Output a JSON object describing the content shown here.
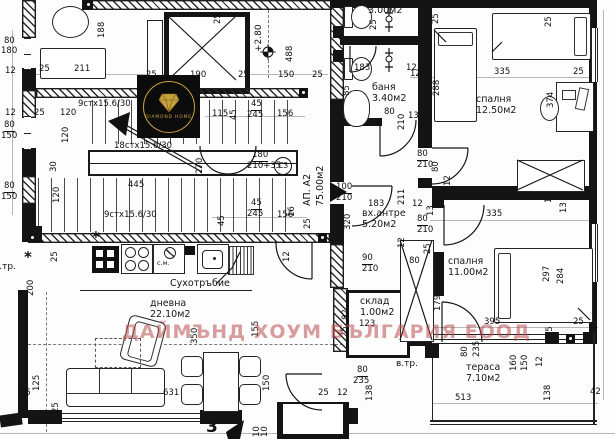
{
  "watermark": {
    "text": "ДАЙМЪНД ХОУМ БЪЛГАРИЯ ЕООД"
  },
  "logo": {
    "brand": "DIAMOND HOME",
    "accent": "#c8a23c",
    "bg": "#0c0c0c"
  },
  "apartment": {
    "label": "АП. А2",
    "area": "75.00м2"
  },
  "rooms": [
    {
      "id": "bath-upper",
      "name": "баня",
      "area": "3.00м2",
      "x": 368,
      "y": -6
    },
    {
      "id": "bath-lower",
      "name": "баня",
      "area": "3.40м2",
      "x": 372,
      "y": 82
    },
    {
      "id": "bedroom-right",
      "name": "спалня",
      "area": "12.50м2",
      "x": 476,
      "y": 94
    },
    {
      "id": "entry-hall",
      "name": "вх.антре",
      "area": "5.20м2",
      "x": 362,
      "y": 208
    },
    {
      "id": "bedroom-lower",
      "name": "спалня",
      "area": "11.00м2",
      "x": 448,
      "y": 256
    },
    {
      "id": "storage",
      "name": "склад",
      "area": "1.00м2",
      "x": 360,
      "y": 296
    },
    {
      "id": "living",
      "name": "дневна",
      "area": "22.10м2",
      "x": 150,
      "y": 298
    },
    {
      "id": "terrace",
      "name": "тераса",
      "area": "7.10м2",
      "x": 466,
      "y": 362
    }
  ],
  "stair_labels": [
    {
      "text": "9стх15.6/30",
      "x": 78,
      "y": 100
    },
    {
      "text": "18стх15.6/30",
      "x": 114,
      "y": 142
    },
    {
      "text": "9стх15.6/30",
      "x": 104,
      "y": 211
    }
  ],
  "annotations": [
    {
      "id": "dry-riser-label",
      "text": "Сухотръбие",
      "x": 170,
      "y": 279,
      "fs": 9.5
    },
    {
      "id": "washing-machine-label",
      "text": "с.м.",
      "x": 157,
      "y": 260,
      "fs": 6.5
    },
    {
      "id": "vent-pipe-label-right",
      "text": "в.тр.",
      "x": 396,
      "y": 360,
      "fs": 9
    },
    {
      "id": "vent-pipe-label-left",
      "text": "в.тр.",
      "x": -6,
      "y": 263,
      "fs": 9
    },
    {
      "id": "level-mark",
      "text": "+2.80",
      "x": 255,
      "y": 52,
      "fs": 9,
      "rot": 1
    },
    {
      "id": "door-code",
      "text": "СЗ",
      "x": 274,
      "y": 157,
      "fs": 7.5,
      "circle": 1
    },
    {
      "id": "axis-number",
      "text": "3",
      "x": 206,
      "y": 419,
      "fs": 17,
      "bold": 1
    }
  ],
  "dimensions": [
    {
      "t": "80",
      "x": 4,
      "y": 37
    },
    {
      "t": "180",
      "x": 1,
      "y": 47
    },
    {
      "t": "12",
      "x": 5,
      "y": 67
    },
    {
      "t": "25",
      "x": 39,
      "y": 65
    },
    {
      "t": "211",
      "x": 74,
      "y": 65
    },
    {
      "t": "188",
      "x": 98,
      "y": 38,
      "r": 1
    },
    {
      "t": "12",
      "x": 5,
      "y": 109
    },
    {
      "t": "25",
      "x": 34,
      "y": 109
    },
    {
      "t": "120",
      "x": 60,
      "y": 109
    },
    {
      "t": "80",
      "x": 4,
      "y": 121,
      "u": 1
    },
    {
      "t": "150",
      "x": 1,
      "y": 132
    },
    {
      "t": "80",
      "x": 4,
      "y": 182,
      "u": 1
    },
    {
      "t": "150",
      "x": 1,
      "y": 193
    },
    {
      "t": "120",
      "x": 62,
      "y": 143,
      "r": 1
    },
    {
      "t": "30",
      "x": 50,
      "y": 172,
      "r": 1
    },
    {
      "t": "25",
      "x": 146,
      "y": 71
    },
    {
      "t": "190",
      "x": 190,
      "y": 71
    },
    {
      "t": "25",
      "x": 238,
      "y": 71
    },
    {
      "t": "150",
      "x": 278,
      "y": 71
    },
    {
      "t": "25",
      "x": 312,
      "y": 71
    },
    {
      "t": "25",
      "x": 214,
      "y": 24,
      "r": 1
    },
    {
      "t": "488",
      "x": 286,
      "y": 62,
      "r": 1
    },
    {
      "t": "445",
      "x": 128,
      "y": 181
    },
    {
      "t": "120",
      "x": 53,
      "y": 203,
      "r": 1
    },
    {
      "t": "270",
      "x": 196,
      "y": 174,
      "r": 1
    },
    {
      "t": "115",
      "x": 212,
      "y": 110
    },
    {
      "t": "45",
      "x": 230,
      "y": 120,
      "r": 1
    },
    {
      "t": "45",
      "x": 251,
      "y": 100,
      "u": 1
    },
    {
      "t": "245",
      "x": 247,
      "y": 111
    },
    {
      "t": "156",
      "x": 277,
      "y": 110
    },
    {
      "t": "45",
      "x": 218,
      "y": 226,
      "r": 1
    },
    {
      "t": "45",
      "x": 251,
      "y": 199,
      "u": 1
    },
    {
      "t": "245",
      "x": 247,
      "y": 210
    },
    {
      "t": "156",
      "x": 277,
      "y": 211
    },
    {
      "t": "16",
      "x": 288,
      "y": 217,
      "r": 1
    },
    {
      "t": "25",
      "x": 304,
      "y": 229,
      "r": 1
    },
    {
      "t": "12",
      "x": 283,
      "y": 262,
      "r": 1
    },
    {
      "t": "180",
      "x": 252,
      "y": 151,
      "u": 1
    },
    {
      "t": "210+35",
      "x": 247,
      "y": 162
    },
    {
      "t": "100",
      "x": 336,
      "y": 183,
      "u": 1
    },
    {
      "t": "210",
      "x": 336,
      "y": 194
    },
    {
      "t": "320",
      "x": 344,
      "y": 230,
      "r": 1
    },
    {
      "t": "211",
      "x": 398,
      "y": 205,
      "r": 1
    },
    {
      "t": "183",
      "x": 368,
      "y": 200
    },
    {
      "t": "90",
      "x": 362,
      "y": 254,
      "u": 1
    },
    {
      "t": "210",
      "x": 362,
      "y": 265
    },
    {
      "t": "25",
      "x": 370,
      "y": 30,
      "r": 1
    },
    {
      "t": "183",
      "x": 354,
      "y": 64
    },
    {
      "t": "12",
      "x": 406,
      "y": 64
    },
    {
      "t": "85",
      "x": 343,
      "y": 96,
      "r": 1
    },
    {
      "t": "80",
      "x": 384,
      "y": 108
    },
    {
      "t": "210",
      "x": 398,
      "y": 130,
      "r": 1
    },
    {
      "t": "12",
      "x": 410,
      "y": 70
    },
    {
      "t": "13",
      "x": 408,
      "y": 112
    },
    {
      "t": "25",
      "x": 432,
      "y": 24,
      "r": 1
    },
    {
      "t": "25",
      "x": 545,
      "y": 27,
      "r": 1
    },
    {
      "t": "335",
      "x": 494,
      "y": 68
    },
    {
      "t": "25",
      "x": 573,
      "y": 68
    },
    {
      "t": "288",
      "x": 433,
      "y": 96,
      "r": 1
    },
    {
      "t": "374",
      "x": 547,
      "y": 108,
      "r": 1
    },
    {
      "t": "80",
      "x": 417,
      "y": 150,
      "u": 1
    },
    {
      "t": "210",
      "x": 417,
      "y": 161
    },
    {
      "t": "80",
      "x": 432,
      "y": 172,
      "r": 1
    },
    {
      "t": "12",
      "x": 444,
      "y": 186,
      "r": 1
    },
    {
      "t": "12",
      "x": 545,
      "y": 203,
      "r": 1
    },
    {
      "t": "13",
      "x": 560,
      "y": 213,
      "r": 1
    },
    {
      "t": "12",
      "x": 412,
      "y": 200
    },
    {
      "t": "13",
      "x": 427,
      "y": 216,
      "r": 1
    },
    {
      "t": "335",
      "x": 486,
      "y": 210
    },
    {
      "t": "80",
      "x": 417,
      "y": 215,
      "u": 1
    },
    {
      "t": "210",
      "x": 417,
      "y": 226
    },
    {
      "t": "25",
      "x": 424,
      "y": 254,
      "r": 1
    },
    {
      "t": "80",
      "x": 409,
      "y": 257
    },
    {
      "t": "179",
      "x": 434,
      "y": 311,
      "r": 1
    },
    {
      "t": "297",
      "x": 543,
      "y": 282,
      "r": 1
    },
    {
      "t": "284",
      "x": 557,
      "y": 284,
      "r": 1
    },
    {
      "t": "82",
      "x": 342,
      "y": 320,
      "r": 1
    },
    {
      "t": "25",
      "x": 341,
      "y": 337,
      "r": 1
    },
    {
      "t": "123",
      "x": 359,
      "y": 320
    },
    {
      "t": "12",
      "x": 398,
      "y": 248,
      "r": 1
    },
    {
      "t": "395",
      "x": 484,
      "y": 318
    },
    {
      "t": "25",
      "x": 573,
      "y": 318
    },
    {
      "t": "25",
      "x": 546,
      "y": 337,
      "r": 1
    },
    {
      "t": "80",
      "x": 461,
      "y": 357,
      "r": 1
    },
    {
      "t": "235",
      "x": 473,
      "y": 357,
      "r": 1
    },
    {
      "t": "160",
      "x": 510,
      "y": 371,
      "r": 1
    },
    {
      "t": "150",
      "x": 521,
      "y": 371,
      "r": 1
    },
    {
      "t": "12",
      "x": 536,
      "y": 367,
      "r": 1
    },
    {
      "t": "138",
      "x": 544,
      "y": 401,
      "r": 1
    },
    {
      "t": "138",
      "x": 366,
      "y": 401,
      "r": 1
    },
    {
      "t": "513",
      "x": 455,
      "y": 394
    },
    {
      "t": "42",
      "x": 590,
      "y": 388
    },
    {
      "t": "80",
      "x": 357,
      "y": 366,
      "u": 1
    },
    {
      "t": "235",
      "x": 353,
      "y": 377
    },
    {
      "t": "25",
      "x": 318,
      "y": 389
    },
    {
      "t": "12",
      "x": 337,
      "y": 389
    },
    {
      "t": "150",
      "x": 263,
      "y": 391,
      "r": 1
    },
    {
      "t": "155",
      "x": 252,
      "y": 337,
      "r": 1
    },
    {
      "t": "200",
      "x": 27,
      "y": 296,
      "r": 1
    },
    {
      "t": "125",
      "x": 33,
      "y": 391,
      "r": 1
    },
    {
      "t": "25",
      "x": 20,
      "y": 389
    },
    {
      "t": "25",
      "x": 52,
      "y": 413,
      "r": 1
    },
    {
      "t": "350",
      "x": 191,
      "y": 344,
      "r": 1
    },
    {
      "t": "631",
      "x": 163,
      "y": 389
    },
    {
      "t": "10",
      "x": 253,
      "y": 437,
      "r": 1
    },
    {
      "t": "10",
      "x": 261,
      "y": 437,
      "r": 1
    },
    {
      "t": "25",
      "x": 51,
      "y": 262,
      "r": 1
    }
  ]
}
